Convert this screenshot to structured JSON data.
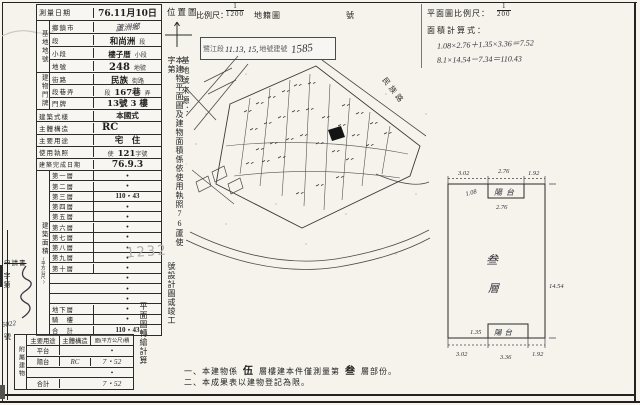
{
  "header": {
    "location_map_label": "位置圖",
    "scale_label": "比例尺：",
    "scale_numerator": "1",
    "scale_denominator": "1200",
    "cadastral_map_label": "地籍圖",
    "sheet_label": "號",
    "stamp_box": {
      "prefix": "鷺江段",
      "handwritten_parcels": "11.13, 15,",
      "mid": "地號建號",
      "handwritten_no": "1585"
    },
    "plan_scale_label": "平面圖比例尺：",
    "plan_scale_numerator": "1",
    "plan_scale_denominator": "200",
    "area_calc_label": "面積計算式：",
    "calc_line1": "1.08×2.76＋1.35×3.36＝7.52",
    "calc_line2": "8.1×14.54－7.34＝110.43"
  },
  "form": {
    "survey_date_label": "測量日期",
    "survey_date_value": "76.11月10日",
    "site_group_label": "基地地號",
    "township_label": "鄉鎮市",
    "township_value": "蘆洲鄉",
    "section_label": "段",
    "section_value": "和尚洲",
    "section_suffix": "段",
    "subsection_label": "小段",
    "subsection_value": "樓子厝",
    "subsection_suffix": "小段",
    "lot_label": "地號",
    "lot_value": "248",
    "lot_suffix": "地號",
    "address_group_label": "建物門牌",
    "street_label": "街路",
    "street_value": "民族",
    "street_suffix": "街路",
    "lane_label": "段巷弄",
    "lane_prefix": "段",
    "lane_value": "167巷",
    "lane_suffix": "弄",
    "door_label": "門牌",
    "door_value": "13號 3 樓",
    "style_label": "建築式樣",
    "style_value": "本國式",
    "structure_label": "主體構造",
    "structure_value": "RC",
    "use_label": "主要用途",
    "use_value": "宅　住",
    "license_label": "使用執照",
    "license_prefix": "使",
    "license_no": "121",
    "license_suffix": "字號",
    "completion_label": "建築完成日期",
    "completion_value": "76.9.3",
    "area_group_label": "建築面積",
    "area_group_unit": "(平方公尺)",
    "floors": [
      {
        "label": "第一層",
        "value": "•"
      },
      {
        "label": "第二層",
        "value": "•"
      },
      {
        "label": "第三層",
        "value": "110・43"
      },
      {
        "label": "第四層",
        "value": "•"
      },
      {
        "label": "第五層",
        "value": "•"
      },
      {
        "label": "第六層",
        "value": "•"
      },
      {
        "label": "第七層",
        "value": "•"
      },
      {
        "label": "第八層",
        "value": "•"
      },
      {
        "label": "第九層",
        "value": "•"
      },
      {
        "label": "第十層",
        "value": "•"
      },
      {
        "label": "",
        "value": "•"
      },
      {
        "label": "",
        "value": "•"
      },
      {
        "label": "",
        "value": "•"
      },
      {
        "label": "地下層",
        "value": "•"
      },
      {
        "label": "騎　樓",
        "value": "•"
      },
      {
        "label": "合　計",
        "value": "110・43"
      }
    ],
    "annex": {
      "group_label": "附屬建物",
      "headers": [
        "主要用途",
        "主體構造",
        "面(平方公尺)積"
      ],
      "rows": [
        {
          "use": "平台",
          "structure": "",
          "area": "•"
        },
        {
          "use": "陽台",
          "structure": "RC",
          "area": "7・52"
        },
        {
          "use": "",
          "structure": "",
          "area": "•"
        },
        {
          "use": "合計",
          "structure": "",
          "area": "7・52"
        }
      ]
    }
  },
  "margin": {
    "application_label": "申請書",
    "zidi_label": "字第",
    "case_no": "6022",
    "hao_label": "號"
  },
  "vertical_notes": {
    "source_label": "基地號來源：",
    "sentence_part1": "本建物平面圖及建物面積係依使用執照76蘆使字第",
    "stamp_number": "1232",
    "sentence_part2": "號設計圖或竣工",
    "sentence_part3": "平面圖轉繪計算"
  },
  "map": {
    "street_label": "民族路"
  },
  "floorplan": {
    "floor_label_char1": "叁",
    "floor_label_char2": "層",
    "balcony_top_label": "陽台",
    "balcony_bottom_label": "陽台",
    "dim_top_left": "3.02",
    "dim_top_mid": "2.76",
    "dim_top_right": "1.92",
    "dim_balcony_top_depth": "1.08",
    "dim_balcony_top_width": "2.76",
    "dim_right": "14.54",
    "dim_bottom_left": "3.02",
    "dim_bottom_mid": "3.36",
    "dim_bottom_right": "1.92",
    "dim_balcony_bottom_depth": "1.35"
  },
  "notes": {
    "line1_a": "一、本建物係",
    "line1_b": "伍",
    "line1_c": "層樓建本件僅測量第",
    "line1_d": "叁",
    "line1_e": "層部份。",
    "line2": "二、本成果表以建物登記為限。"
  }
}
